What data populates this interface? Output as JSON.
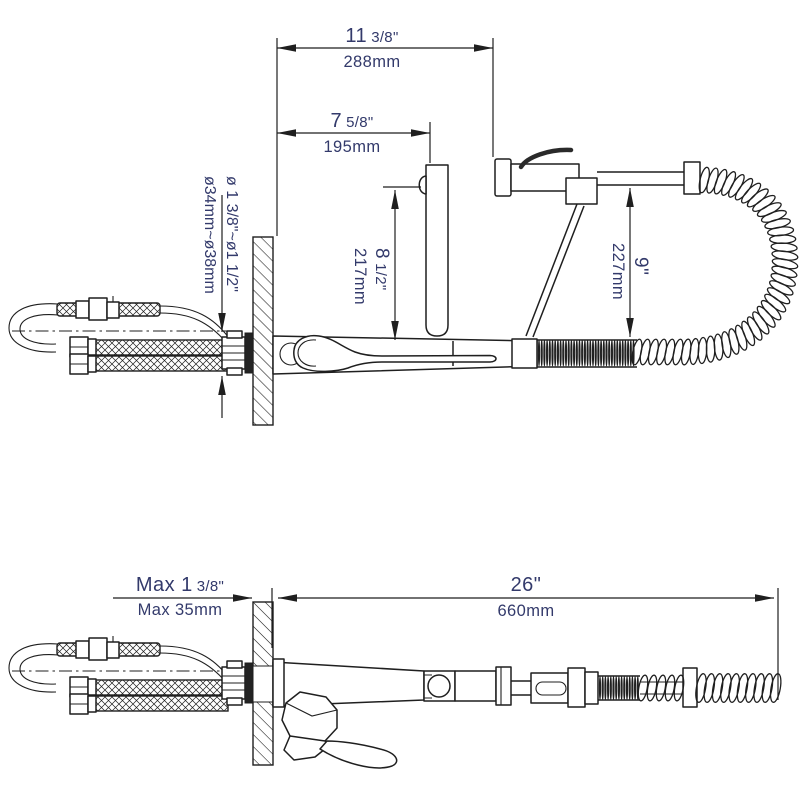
{
  "drawing": {
    "title": "faucet installation dimension drawing",
    "text_color": "#333a6b",
    "line_color": "#1f1f1f"
  },
  "dimensions": {
    "top_width": {
      "in_main": "11",
      "in_frac": "3/8\"",
      "mm": "288mm"
    },
    "spout_reach": {
      "in_main": "7",
      "in_frac": "5/8\"",
      "mm": "195mm"
    },
    "spout_height": {
      "in_main": "8",
      "in_frac": "1/2\"",
      "mm": "217mm"
    },
    "spray_height": {
      "in_main": "9\"",
      "mm": "227mm"
    },
    "hole_diameter": {
      "in_main": "ø 1 3/8\"~ø1 1/2\"",
      "mm": "ø34mm~ø38mm"
    },
    "wall_thickness": {
      "in_main": "Max 1",
      "in_frac": "3/8\"",
      "mm": "Max 35mm"
    },
    "overall_length": {
      "in_main": "26\"",
      "mm": "660mm"
    }
  }
}
